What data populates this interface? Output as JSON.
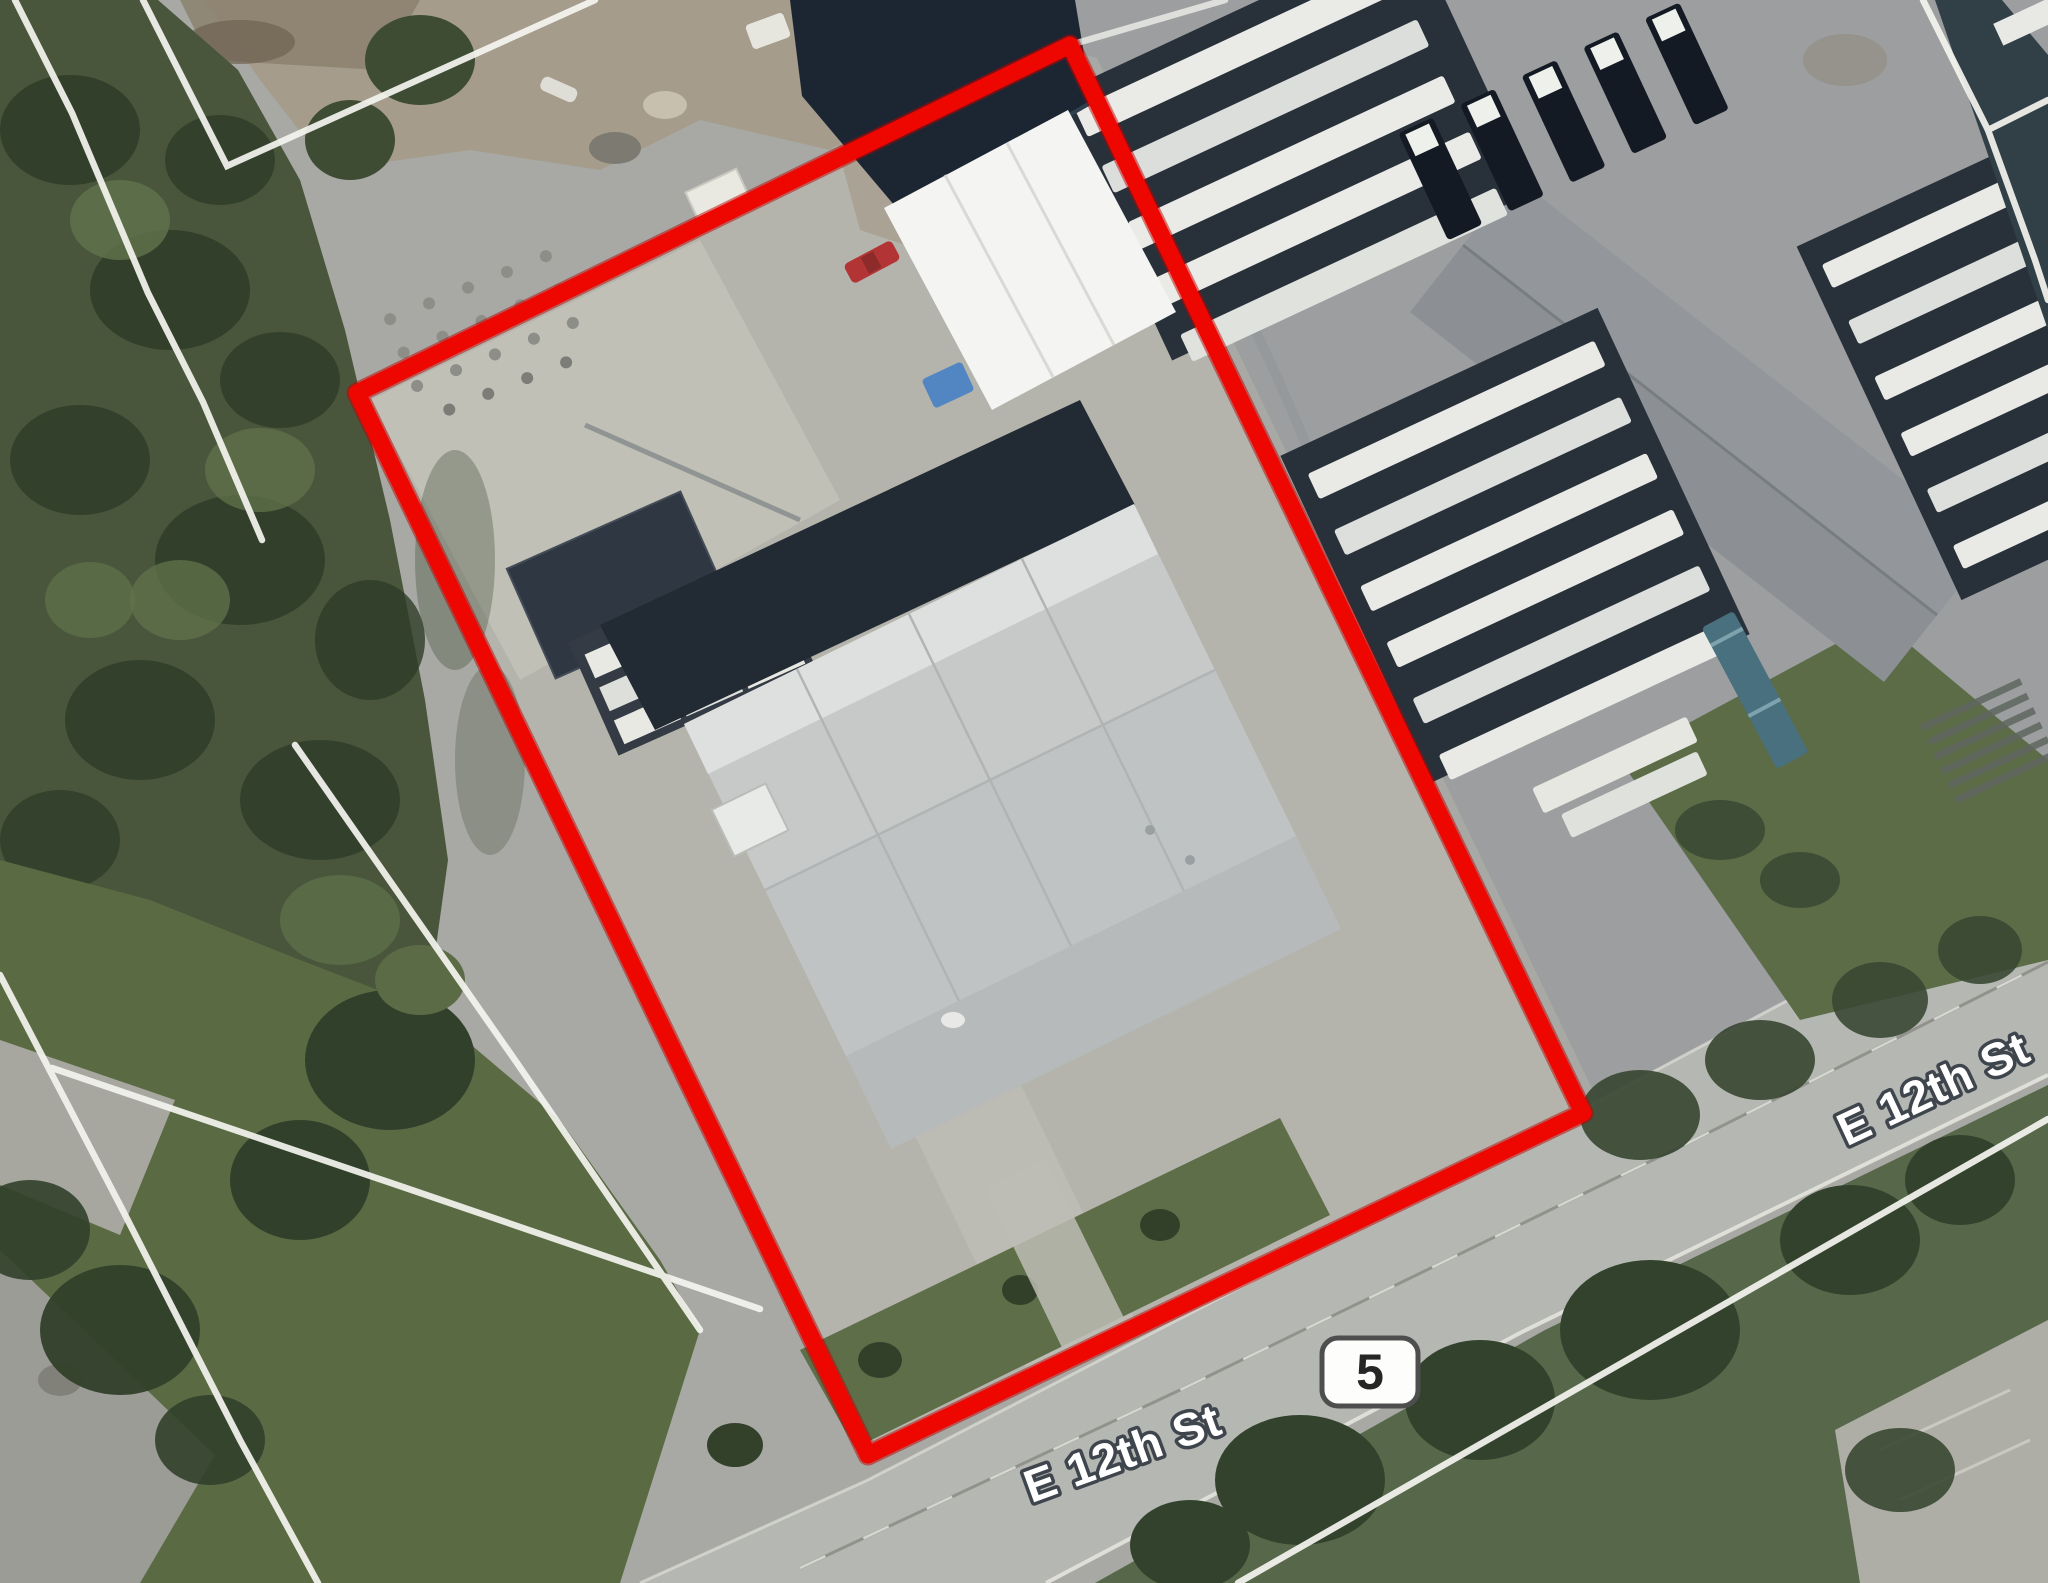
{
  "map": {
    "view": "satellite-aerial-with-parcel-overlay",
    "street_labels": [
      {
        "id": "street-label-bottom",
        "text": "E 12th St"
      },
      {
        "id": "street-label-right",
        "text": "E 12th St"
      }
    ],
    "route_shield": {
      "number": "5",
      "shape": "rounded-rectangle",
      "fill": "#fdfdfb",
      "border": "#4e4e4e",
      "text_color": "#262626"
    },
    "parcel_boundary": {
      "color": "#ee0600",
      "stroke_width_px": 17,
      "shape": "quadrilateral"
    },
    "label_style": {
      "fill": "#ffffff",
      "halo": "#3f454d"
    },
    "parcel_line_color": "#f5f5f0"
  }
}
